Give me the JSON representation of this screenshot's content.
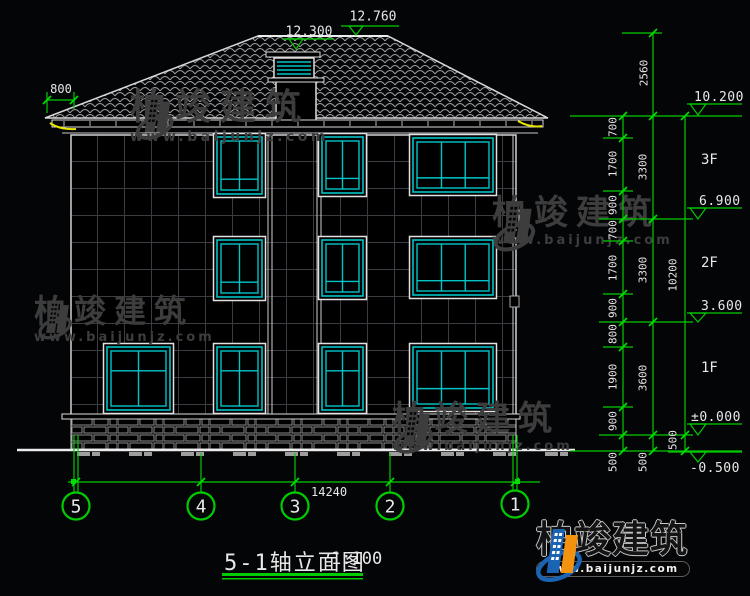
{
  "colors": {
    "green": "#00cc00",
    "cyan": "#00c4c8",
    "white": "#e0e0e0",
    "yellow": "#e6e600",
    "watermark_gray": "#3d3d3d",
    "logo_blue": "#1b64b4",
    "logo_orange": "#f2920f"
  },
  "top": {
    "ridge_level": "12.760",
    "dormer_level": "12.300",
    "eave_overhang": "800"
  },
  "right": {
    "chain_top": "2560",
    "col1": [
      "700",
      "1700",
      "900",
      "700",
      "1700",
      "900",
      "800",
      "1900",
      "900",
      "500"
    ],
    "col2": [
      "3300",
      "3300",
      "3600",
      "500"
    ],
    "col3": [
      "10200",
      "500"
    ],
    "levels": [
      "10.200",
      "6.900",
      "3.600",
      "±0.000",
      "-0.500"
    ],
    "floors": [
      "3F",
      "2F",
      "1F"
    ]
  },
  "bottom": {
    "total_width": "14240",
    "axes": [
      "5",
      "4",
      "3",
      "2",
      "1"
    ],
    "title": "5-1轴立面图",
    "scale": "1:100"
  },
  "watermark": {
    "brand": "柏竣建筑",
    "url": "www.baijunjz.com"
  },
  "logo": {
    "brand": "柏竣建筑",
    "url": "www.baijunjz.com"
  }
}
